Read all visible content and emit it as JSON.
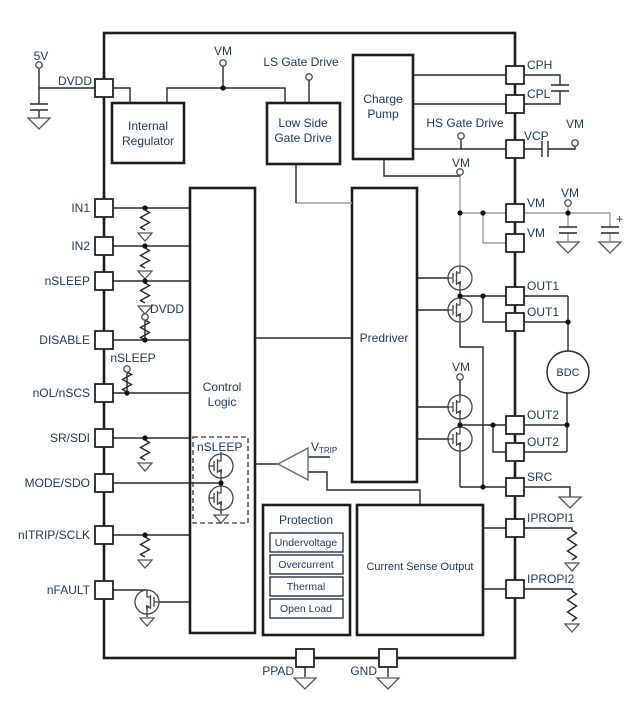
{
  "pins": {
    "left": [
      "DVDD",
      "IN1",
      "IN2",
      "nSLEEP",
      "DISABLE",
      "nOL/nSCS",
      "SR/SDI",
      "MODE/SDO",
      "nITRIP/SCLK",
      "nFAULT"
    ],
    "right": [
      "CPH",
      "CPL",
      "VCP",
      "VM",
      "VM",
      "OUT1",
      "OUT1",
      "OUT2",
      "OUT2",
      "SRC",
      "IPROPI1",
      "IPROPI2"
    ],
    "bottom": [
      "PPAD",
      "GND"
    ]
  },
  "terminals": {
    "supply_5v": "5V",
    "vm_top": "VM",
    "ls_gate_drive": "LS Gate Drive",
    "hs_gate_drive": "HS Gate Drive",
    "vm_vcp": "VM",
    "vm_bulk": "VM",
    "vm_bridge1": "VM",
    "vm_bridge2": "VM",
    "dvdd_pullup": "DVDD",
    "nsleep_pullup": "nSLEEP",
    "plus": "+"
  },
  "blocks": {
    "internal_regulator": [
      "Internal",
      "Regulator"
    ],
    "low_side_gate_drive": [
      "Low Side",
      "Gate Drive"
    ],
    "charge_pump": [
      "Charge",
      "Pump"
    ],
    "predriver": "Predriver",
    "control_logic": [
      "Control",
      "Logic"
    ],
    "current_sense_output": "Current Sense Output",
    "nsleep_switch_box": "nSLEEP",
    "protection": {
      "title": "Protection",
      "items": [
        "Undervoltage",
        "Overcurrent",
        "Thermal",
        "Open Load"
      ]
    }
  },
  "comparator": {
    "label": "V",
    "sub": "TRIP"
  },
  "motor": {
    "label": "BDC"
  },
  "colors": {
    "wire": "#282828",
    "gray_wire": "#9c9c9c",
    "text": "#223a50",
    "block_border": "#1d1d1d"
  }
}
